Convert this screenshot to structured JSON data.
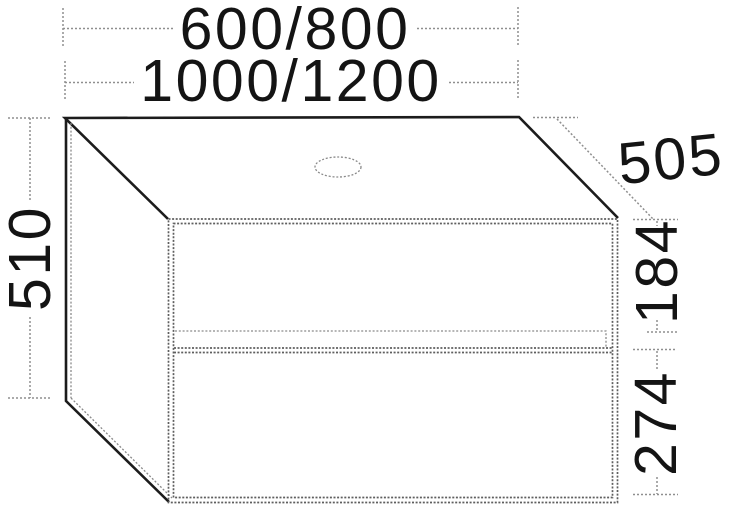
{
  "drawing": {
    "labels": {
      "width_variants_line1": "600/800",
      "width_variants_line2": "1000/1200",
      "overall_height": "510",
      "depth": "505",
      "upper_drawer_height": "184",
      "lower_drawer_height": "274"
    },
    "colors": {
      "background": "#ffffff",
      "edge_dark": "#1c1c1c",
      "edge_gray": "#5f5f5f",
      "edge_gray_light": "#8a8a8a",
      "dim_gray": "#8f8f8f",
      "text_color": "#141414"
    }
  }
}
